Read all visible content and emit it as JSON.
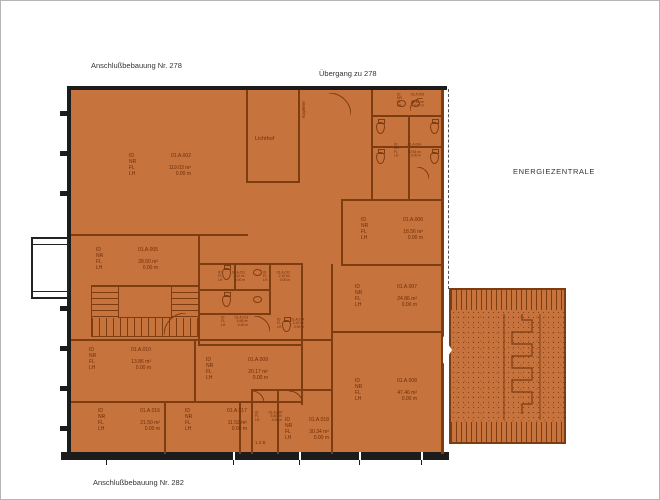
{
  "colors": {
    "plan_fill": "#c7733d",
    "wall": "#7e3c11",
    "outline": "#1c1c1c",
    "label_text": "#6e2e07",
    "outside_text": "#333333"
  },
  "outside_labels": {
    "top_left": "Anschlußbebauung Nr. 278",
    "top_right": "Übergang zu 278",
    "right": "ENERGIEZENTRALE",
    "bottom": "Anschlußbebauung Nr. 282"
  },
  "field_labels": {
    "id": "ID",
    "nr": "NR",
    "fl": "FL",
    "lh": "LH"
  },
  "rooms": [
    {
      "id": "01.A.002",
      "fl": "119.03 m²",
      "lh": "0.00 m"
    },
    {
      "id": "01.A.005",
      "fl": "28.50 m²",
      "lh": "0.00 m"
    },
    {
      "id": "01.A.006",
      "fl": "18.56 m²",
      "lh": "0.00 m"
    },
    {
      "id": "01.A.007",
      "fl": "24.86 m²",
      "lh": "0.00 m"
    },
    {
      "id": "01.A.010",
      "fl": "13.86 m²",
      "lh": "0.00 m"
    },
    {
      "id": "01.A.009",
      "fl": "20.17 m²",
      "lh": "0.00 m"
    },
    {
      "id": "01.A.008",
      "fl": "47.46 m²",
      "lh": "0.00 m"
    },
    {
      "id": "01.A.016",
      "fl": "21.50 m²",
      "lh": "0.00 m"
    },
    {
      "id": "01.A.017",
      "fl": "11.52 m²",
      "lh": "0.00 m"
    },
    {
      "id": "01.A.018",
      "fl": "30.34 m²",
      "lh": "0.00 m"
    }
  ],
  "small_rooms": [
    {
      "id": "01.A.003",
      "fl": "11.48 m²",
      "lh": "0.00 m"
    },
    {
      "id": "01.A.004",
      "fl": "10.93 m²",
      "lh": "0.00 m"
    },
    {
      "id": "01.A.011",
      "fl": "2.10 m²",
      "lh": "0.00 m"
    },
    {
      "id": "01.A.012",
      "fl": "2.10 m²",
      "lh": "0.00 m"
    },
    {
      "id": "01.A.013",
      "fl": "4.65 m²",
      "lh": "0.00 m"
    },
    {
      "id": "01.A.014",
      "fl": "3.20 m²",
      "lh": "0.00 m"
    },
    {
      "id": "01.A.015",
      "fl": "5.40 m²",
      "lh": "0.00 m"
    }
  ],
  "room_names": {
    "lichthof": "Lichthof",
    "shaft_vertical": "Kopierer",
    "level_mark": "1.2 B"
  }
}
